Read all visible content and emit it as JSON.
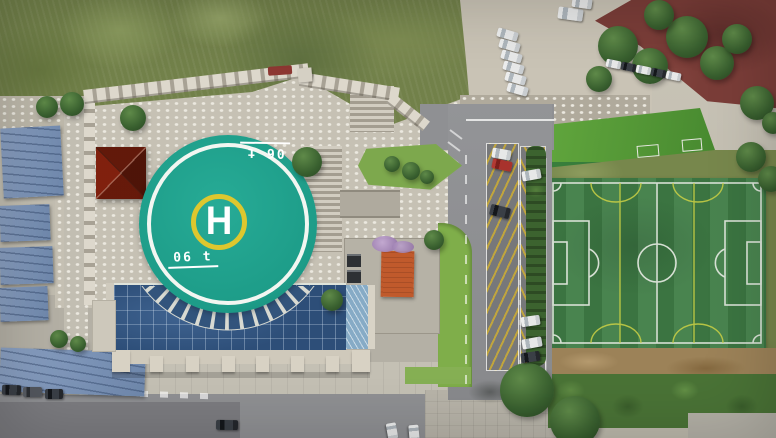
{
  "scene": {
    "kind": "aerial-photo",
    "subjects": [
      "rooftop-helipad",
      "glass-atrium-building",
      "football-field",
      "roadside-parking",
      "blue-roof-sheds",
      "wild-grass-lot"
    ]
  },
  "helipad": {
    "letter": "H",
    "weight_marking_bottom": "06 t",
    "weight_marking_top": "06 t"
  },
  "colors": {
    "pad-teal": "#1d9c88",
    "pad-ring-white": "#f2f6f1",
    "touchdown-yellow": "#ddc72e",
    "marking-white": "#ffffff",
    "turf-green": "#3f7d46",
    "turf-line-white": "#e8ece4",
    "pitch-yellow": "#ccd145",
    "roof-blue": "#8099bd",
    "glass-blue": "#2d4e78",
    "green-roof": "#55a23e",
    "asphalt": "#8f9093",
    "concrete": "#c6c1b4",
    "grass-wild": "#72814a",
    "lawn-green": "#7fae4a",
    "parking-stripe-yellow": "#c0a53e",
    "dirt-brown": "#9c8258",
    "maroon-ground": "#7a3d38",
    "orange-structure": "#c05a2c"
  }
}
